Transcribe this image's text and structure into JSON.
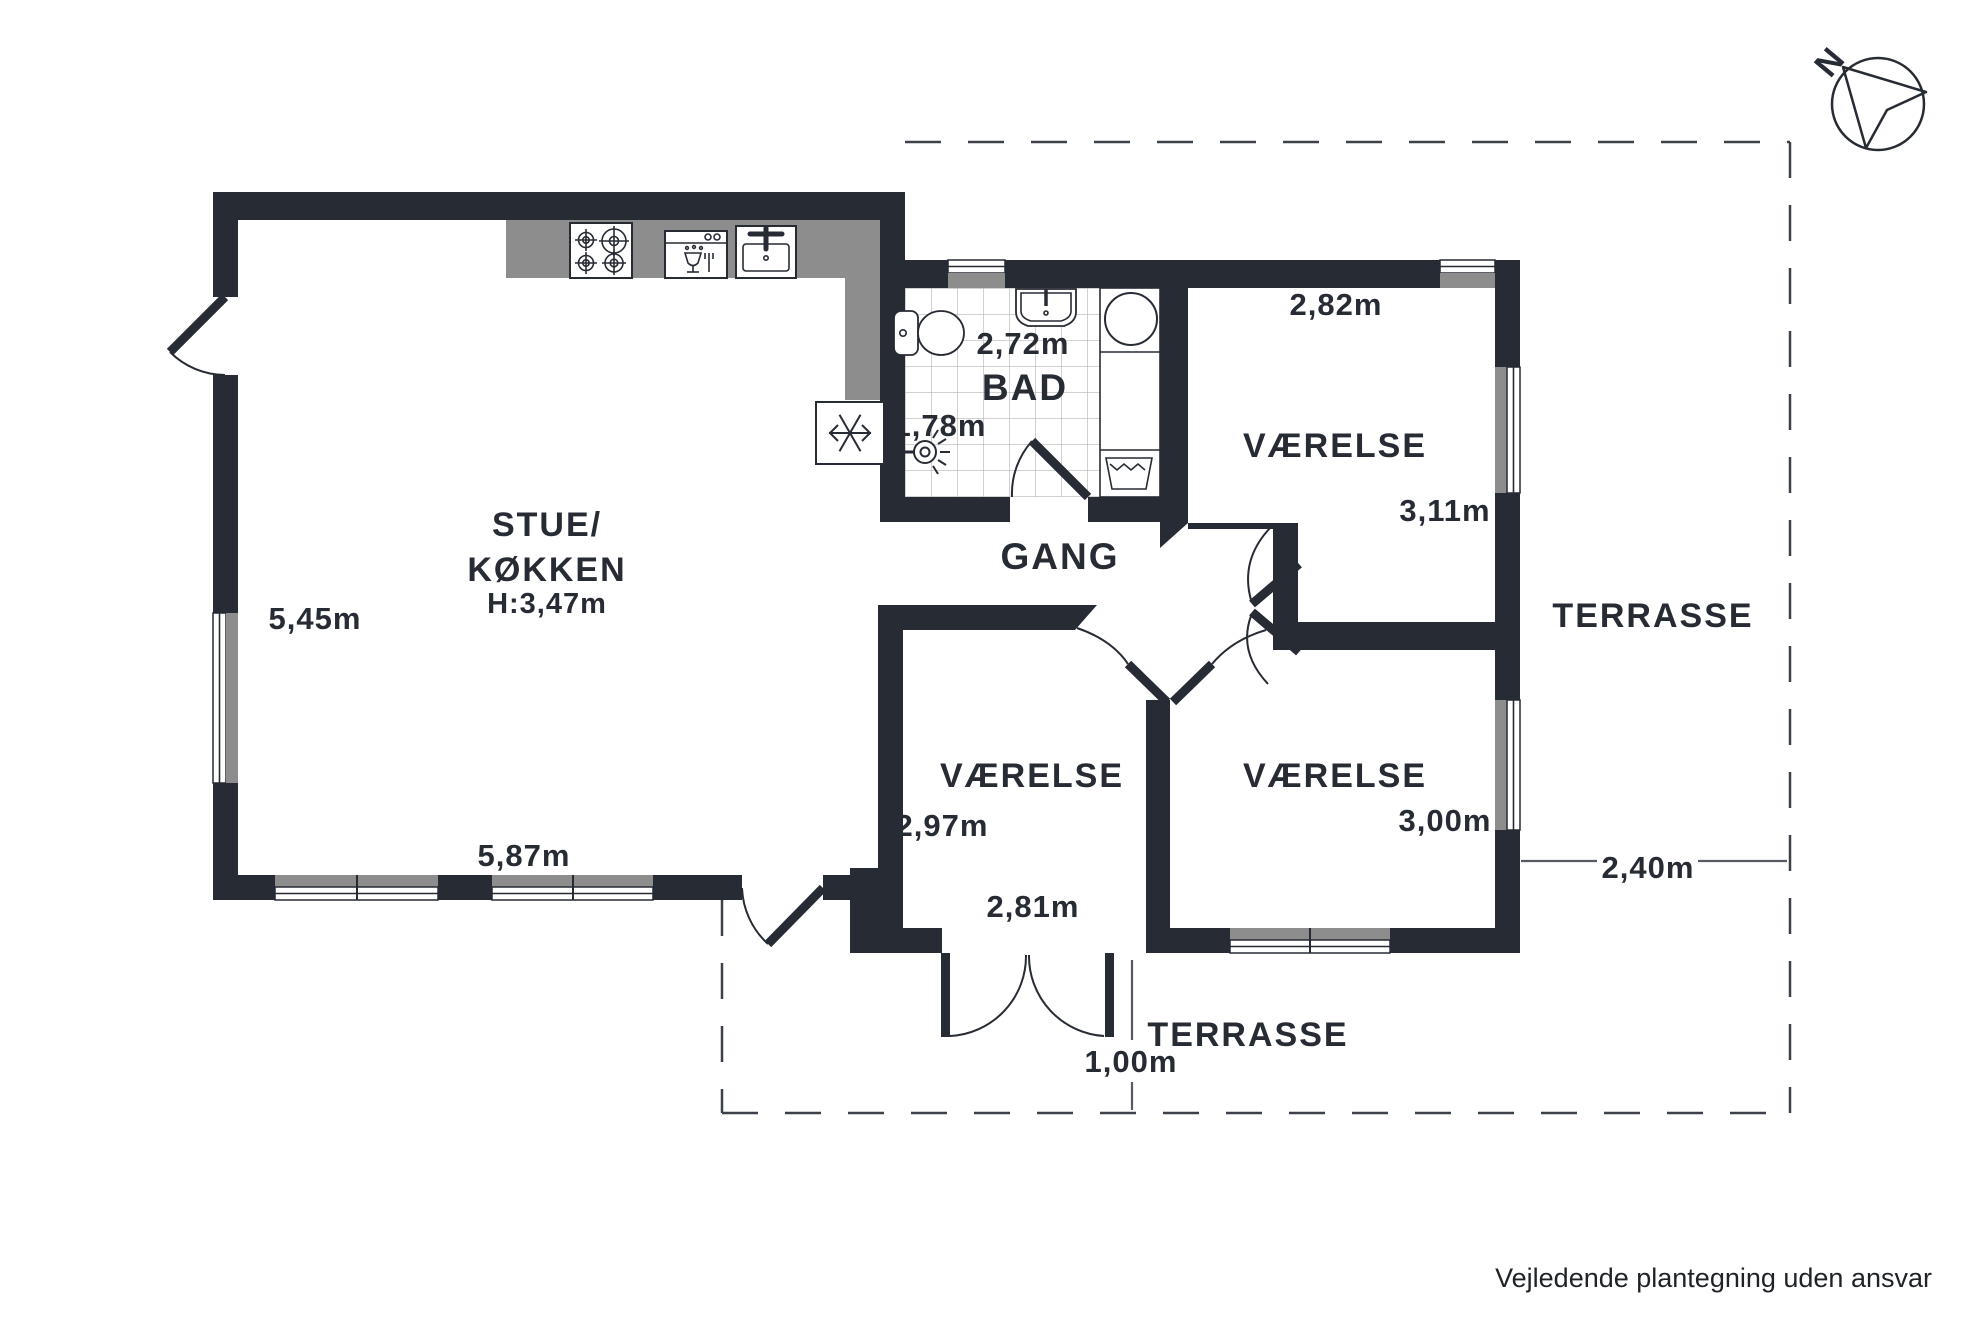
{
  "disclaimer": "Vejledende plantegning uden ansvar",
  "compass": {
    "north_label": "N"
  },
  "rooms": {
    "stue_koekken": {
      "name_line1": "STUE/",
      "name_line2": "KØKKEN",
      "ceiling_height": "H:3,47m",
      "depth": "5,45m",
      "width": "5,87m"
    },
    "bad": {
      "name": "BAD",
      "width": "2,72m",
      "depth": "1,78m"
    },
    "gang": {
      "name": "GANG"
    },
    "vaerelse_ne": {
      "name": "VÆRELSE",
      "width": "2,82m",
      "depth": "3,11m"
    },
    "vaerelse_s": {
      "name": "VÆRELSE",
      "depth": "2,97m",
      "width": "2,81m"
    },
    "vaerelse_se": {
      "name": "VÆRELSE",
      "width": "3,00m"
    },
    "terrasse_e": {
      "name": "TERRASSE",
      "width": "2,40m"
    },
    "terrasse_s": {
      "name": "TERRASSE",
      "door_width": "1,00m"
    }
  },
  "icons": {
    "kitchen": [
      "stove-burners",
      "dishwasher",
      "kitchen-sink",
      "refrigerator-snowflake"
    ],
    "bathroom": [
      "toilet",
      "washbasin",
      "washing-machine",
      "laundry-tub",
      "shower-head"
    ],
    "compass": "north-arrow"
  },
  "colors": {
    "wall": "#272b34",
    "window_fill": "#8d8d8d",
    "tile_line": "#b8b8b8",
    "boundary_dash": "#3d4149",
    "text": "#272b34"
  }
}
